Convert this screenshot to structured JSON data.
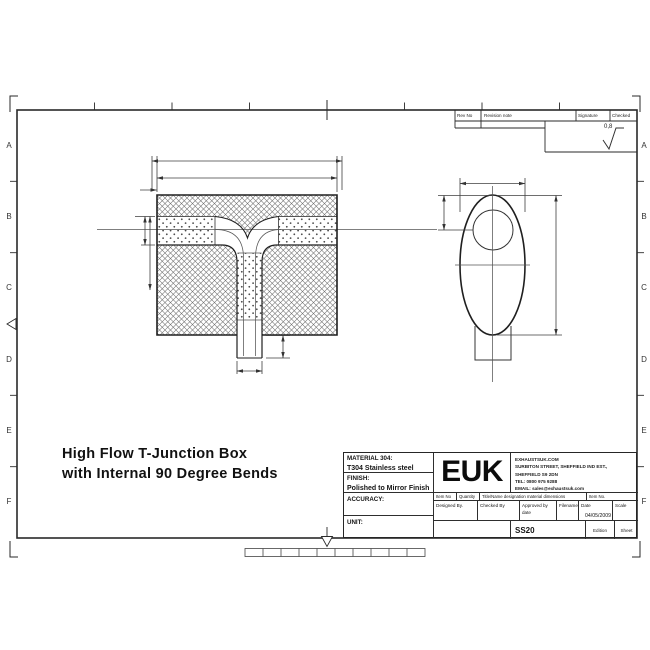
{
  "sheet": {
    "border_letters": [
      "A",
      "B",
      "C",
      "D",
      "E",
      "F"
    ],
    "roughness_value": "0,8"
  },
  "revision_table": {
    "rev_no": "Rev No",
    "revision_note": "Revision note",
    "signature": "Signature",
    "checked": "Checked"
  },
  "drawing_title": {
    "line1": "High Flow T-Junction Box",
    "line2": "with Internal 90 Degree Bends"
  },
  "title_block": {
    "material_label": "MATERIAL 304:",
    "material_value": "T304 Stainless steel",
    "finish_label": "FINISH:",
    "finish_value": "Polished to Mirror Finish",
    "accuracy_label": "ACCURACY:",
    "unit_label": "UNIT:",
    "logo": "EUK",
    "company_lines": [
      "EXHAUSTSUK.COM",
      "SURBITON STREET, SHEFFIELD IND EST.,",
      "SHEFFIELD S9 2DN",
      "TEL: 0800 975 9288",
      "EMAIL: sales@exhaustsuk.com"
    ],
    "item_no": "Item No",
    "quantity": "Quantity",
    "title_name": "Title/Name designation material dimensions",
    "item_no2": "Item No.",
    "designed_by": "Designed By.",
    "checked_by": "Checked By",
    "approved_by": "Approved by date",
    "filename_label": "Filename",
    "date_label": "Date",
    "scale_label": "Scale",
    "date_value": "04/05/2009",
    "drawing_number": "SS20",
    "edition_label": "Edition",
    "sheet_label": "Sheet"
  }
}
